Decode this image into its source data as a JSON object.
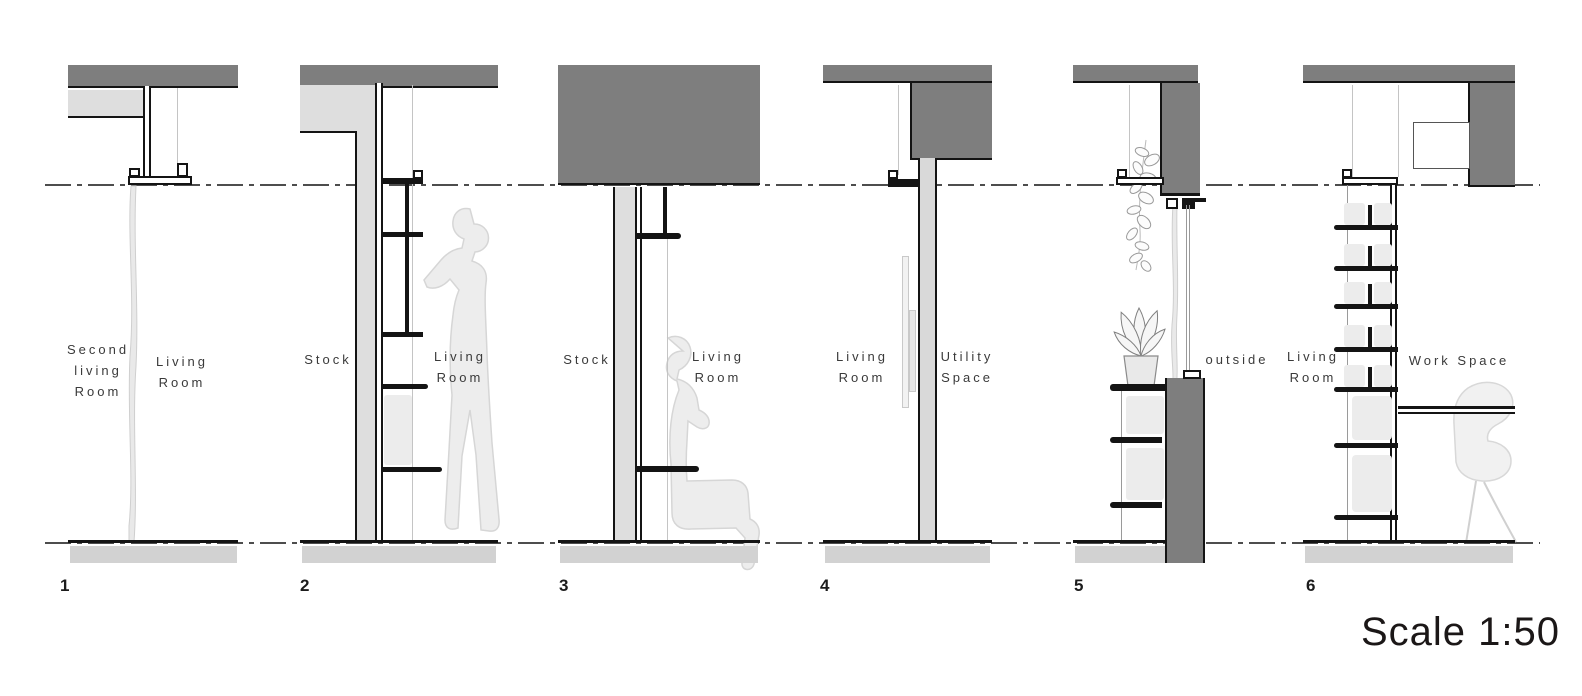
{
  "scale_label": "Scale 1:50",
  "sections": [
    {
      "number": "1",
      "labels": [
        "Second\nliving\nRoom",
        "Living\nRoom"
      ],
      "figures": [
        "curtain"
      ]
    },
    {
      "number": "2",
      "labels": [
        "Stock",
        "Living\nRoom"
      ],
      "figures": [
        "person-standing",
        "shelves"
      ]
    },
    {
      "number": "3",
      "labels": [
        "Stock",
        "Living\nRoom"
      ],
      "figures": [
        "person-sitting",
        "bench"
      ]
    },
    {
      "number": "4",
      "labels": [
        "Living\nRoom",
        "Utility\nSpace"
      ],
      "figures": [
        "sliding-door"
      ]
    },
    {
      "number": "5",
      "labels": [
        "outside"
      ],
      "figures": [
        "hanging-vine",
        "potted-plant",
        "cabinet",
        "curtain"
      ]
    },
    {
      "number": "6",
      "labels": [
        "Living\nRoom",
        "Work Space"
      ],
      "figures": [
        "bookshelf",
        "desk",
        "chair"
      ]
    }
  ],
  "colors": {
    "slab_dark": "#7e7e7e",
    "wall_light": "#dedede",
    "floor_slab": "#d2d2d2",
    "silhouette": "#ededed",
    "line": "#141414",
    "datum_line": "#4d4d4d",
    "label_text": "#3a3a3a"
  }
}
